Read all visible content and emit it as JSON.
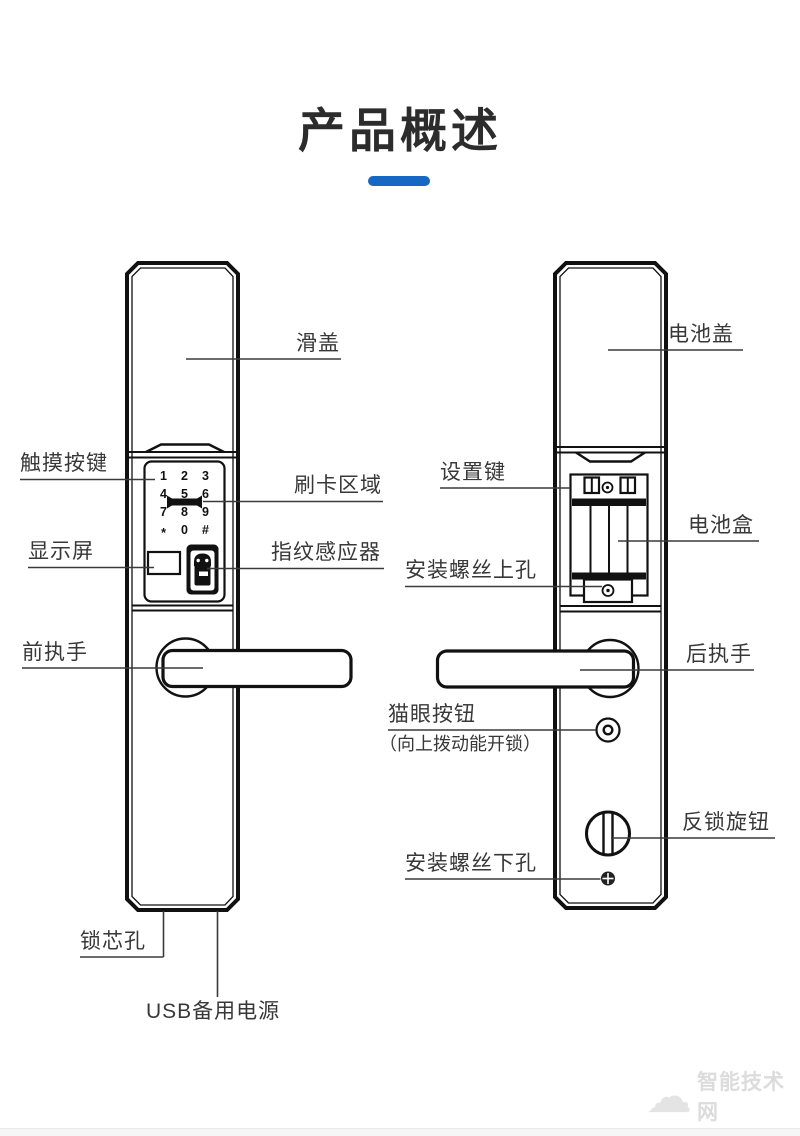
{
  "title": "产品概述",
  "accent_color": "#1767c5",
  "front_panel": {
    "labels": {
      "slide_cover": "滑盖",
      "touch_keys": "触摸按键",
      "card_area": "刷卡区域",
      "display_screen": "显示屏",
      "fingerprint_sensor": "指纹感应器",
      "front_handle": "前执手",
      "lock_cylinder_hole": "锁芯孔",
      "usb_backup_power": "USB备用电源"
    },
    "keypad_keys": [
      "1",
      "2",
      "3",
      "4",
      "5",
      "6",
      "7",
      "8",
      "9",
      "*",
      "0",
      "#"
    ]
  },
  "rear_panel": {
    "labels": {
      "battery_cover": "电池盖",
      "settings_key": "设置键",
      "battery_box": "电池盒",
      "screw_hole_upper": "安装螺丝上孔",
      "rear_handle": "后执手",
      "peephole_button": "猫眼按钮",
      "peephole_button_note": "（向上拨动能开锁）",
      "anti_lock_knob": "反锁旋钮",
      "screw_hole_lower": "安装螺丝下孔"
    }
  },
  "watermark": {
    "brand_text": "智能技术网",
    "icon": "cloud-icon"
  }
}
